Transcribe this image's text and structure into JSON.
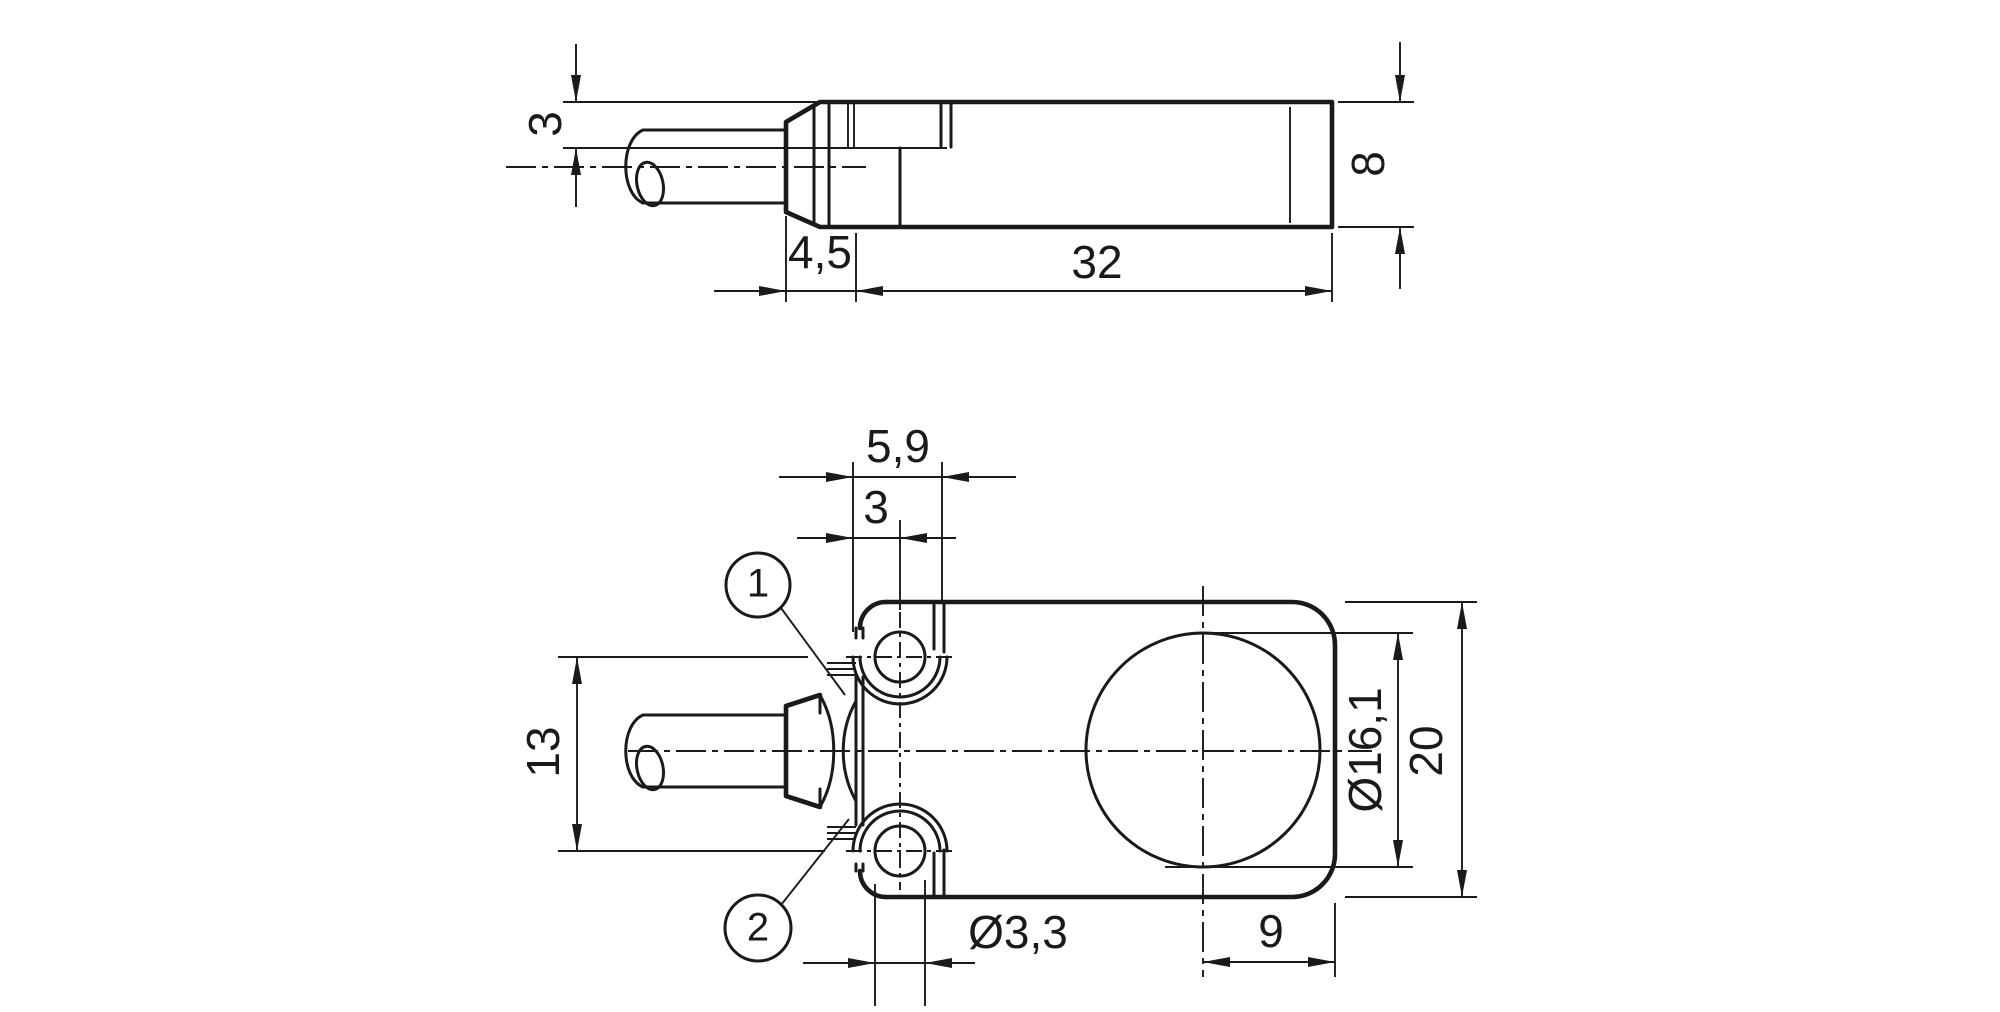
{
  "drawing": {
    "type": "technical-dimension-drawing",
    "colors": {
      "line": "#1a1a1a",
      "background": "#ffffff"
    },
    "dims": {
      "side": {
        "d3": "3",
        "d45": "4,5",
        "d32": "32",
        "d8": "8"
      },
      "plan": {
        "d59": "5,9",
        "d3": "3",
        "d13": "13",
        "d33": "Ø3,3",
        "d161": "Ø16,1",
        "d20": "20",
        "d9": "9"
      }
    },
    "callouts": {
      "c1": "1",
      "c2": "2"
    }
  }
}
